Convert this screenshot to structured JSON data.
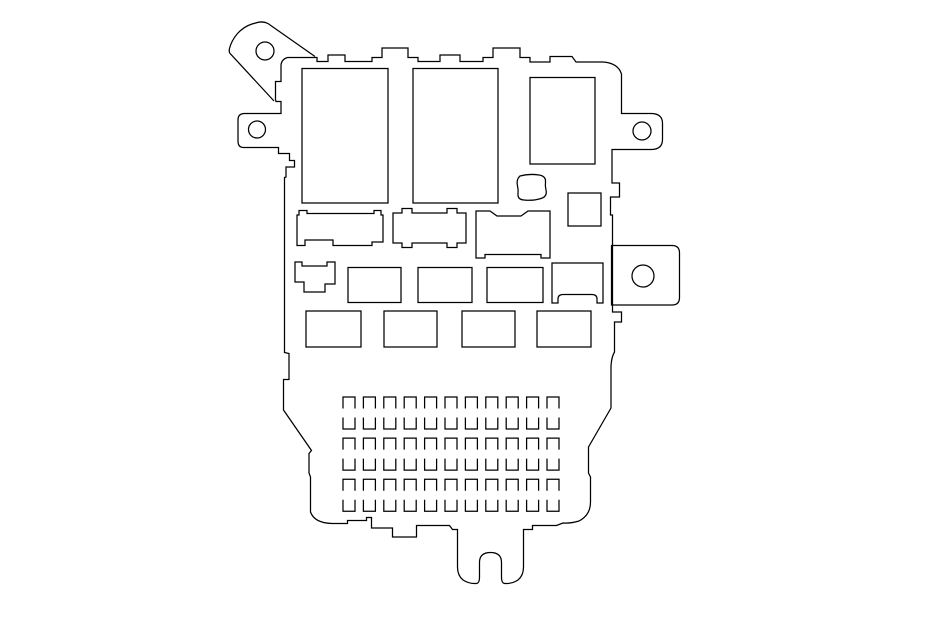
{
  "canvas": {
    "width": 950,
    "height": 623,
    "background_color": "#ffffff",
    "line_color": "#000000",
    "line_width": 1.25
  },
  "diagram": {
    "kind": "fuse-box-outline-drawing",
    "body": {
      "name": "fuse-box-body-outline",
      "d": "M 295,57.5 H 317 V 61.5 H 328 V 55 H 345 V 61.5 H 372 V 57.5 H 382 V 48 H 408 V 57.5 H 418 V 61.5 H 440 V 55 H 460 V 61.5 H 483 V 57.5 H 493 V 48 H 520 V 57.5 H 530 V 62 H 550 V 56.5 H 572 L 576,62 H 603 Q 618,63 621.5,74 V 113.5 H 651 Q 662.5,113.5 662.5,123.5 V 139.5 Q 662.5,149.5 651,149.5 H 612 V 183 H 619.5 V 197 H 610.5 V 215 H 612.5 V 312 H 621.5 V 322 H 614.5 V 352 Q 611.5,357 611,366 V 408 L 588.5,447 V 473 L 590.5,477 V 502 Q 590.5,515 579,521 Q 571,523.5 563,523 L 556.5,525.5 H 532.5 V 529.5 H 523.5 V 567 Q 523.5,575.5 518,580 Q 512.5,583.5 506.5,583.5 H 504.5 Q 501.5,583 501.5,577.5 V 562.5 Q 501.5,552.5 490.5,552.5 Q 479.5,552.5 479.5,562.5 V 577.5 Q 479.5,583 476.5,583.5 H 474.5 Q 468.5,583.5 463,580 Q 457.5,575.5 457.5,567 V 529.5 H 452.5 L 449.5,525.5 H 416.5 V 537 H 392.5 V 528 H 371.5 V 517.5 H 366.5 V 520.5 H 347.5 V 523.5 H 332 Q 314.5,523 310.5,512 V 477 L 309,473 V 453.5 L 311.5,450.5 L 283.5,410 V 379.5 H 289 V 353.5 L 284.5,352.5 V 177.5 L 286,177 V 167 H 294.5 V 160.5 H 289.5 V 153.5 H 278.5 V 147.5 H 243.5 Q 238,147.5 238,141 V 120 Q 238,113.5 244.5,113.5 H 281 V 101.5 H 276 L 275.5,99.5 V 81.5 H 281 V 66 Q 281,59.5 287.5,57.5 Z"
    },
    "open_paths": [
      {
        "name": "mounting-bracket-top-left",
        "d": "M 315,56.5 L 268,23.5 Q 263,21 257.5,22.5 L 252,24 Q 244,26.5 237.5,33.5 Q 231.5,40.5 229.5,48.5 Q 228.5,52.5 231,54.5 L 274,101"
      }
    ],
    "closed_shapes": [
      {
        "name": "connector-tab-right",
        "d": "M 611.5,245.5 H 672 Q 679.5,245.5 679.5,253 V 297.5 Q 679.5,305 672,305 H 611.5 Z"
      },
      {
        "name": "relay-socket-left",
        "d": "M 297,215 L 299,215 V 210.5 H 307 V 213.5 H 374 V 210.5 H 381 V 215 L 383,215 V 242 L 372,242 V 245.5 L 333,245.5 V 240 L 305,240 V 245.5 L 297,245.5 Z"
      },
      {
        "name": "relay-socket-middle",
        "d": "M 393,213 H 402 V 208.5 H 412 V 213 H 447 V 208.5 H 457 V 213 H 466 V 243 H 457 V 247.5 H 447 V 243 H 412 V 247.5 H 402 V 243 H 393 Z"
      },
      {
        "name": "relay-socket-right",
        "d": "M 476,211 H 490 L 497,216 H 521 L 528,211 H 550 V 258 H 541 V 254.5 H 485 V 258 H 476 Z"
      },
      {
        "name": "connector-blob",
        "d": "M 520,176 Q 529,173.5 539,175 Q 546,176 545.5,182 Q 545,186 546,190 Q 547.5,196.5 541,198.5 Q 533,201 524,200 Q 517.5,199.5 518,194 Q 518.5,190 517.5,186 Q 516,179.5 520,176 Z"
      },
      {
        "name": "fuse-slot-boot",
        "d": "M 295,262 H 302 V 266 H 327 V 262 H 335 V 284 H 325 V 292 H 304 V 282 H 295 Z"
      },
      {
        "name": "fuse-slot-arch-bottom",
        "d": "M 552,263 H 603 V 303 H 597 V 299 Q 597,294.5 592,294.5 H 563 Q 558,294.5 558,299 V 303 H 552 Z"
      }
    ],
    "rects": [
      {
        "name": "relay-large-1",
        "x": 302,
        "y": 68.5,
        "w": 86,
        "h": 134.5
      },
      {
        "name": "relay-large-2",
        "x": 413,
        "y": 68.5,
        "w": 85,
        "h": 134.5
      },
      {
        "name": "relay-large-3",
        "x": 530,
        "y": 77.5,
        "w": 65,
        "h": 86.5
      },
      {
        "name": "relay-small-square",
        "x": 568,
        "y": 193,
        "w": 33,
        "h": 33
      },
      {
        "name": "fuse-slot-row1-1",
        "x": 348,
        "y": 267.5,
        "w": 53,
        "h": 35
      },
      {
        "name": "fuse-slot-row1-2",
        "x": 418,
        "y": 267.5,
        "w": 54,
        "h": 35
      },
      {
        "name": "fuse-slot-row1-3",
        "x": 487,
        "y": 267.5,
        "w": 56,
        "h": 35
      },
      {
        "name": "fuse-slot-row2-1",
        "x": 306,
        "y": 311,
        "w": 55,
        "h": 36
      },
      {
        "name": "fuse-slot-row2-2",
        "x": 384,
        "y": 311,
        "w": 53,
        "h": 36
      },
      {
        "name": "fuse-slot-row2-3",
        "x": 462,
        "y": 311,
        "w": 53,
        "h": 36
      },
      {
        "name": "fuse-slot-row2-4",
        "x": 537,
        "y": 311,
        "w": 54,
        "h": 36
      }
    ],
    "holes": [
      {
        "name": "bolt-hole-top-left",
        "cx": 265,
        "cy": 51,
        "r": 9
      },
      {
        "name": "bolt-hole-left",
        "cx": 257,
        "cy": 129.5,
        "r": 8.5
      },
      {
        "name": "bolt-hole-right",
        "cx": 642,
        "cy": 131,
        "r": 9
      },
      {
        "name": "bolt-hole-connector",
        "cx": 643,
        "cy": 276,
        "r": 11
      }
    ],
    "terminal_grid": {
      "name": "terminal-pin-grid",
      "cols": 11,
      "rows": 6,
      "x0": 343,
      "y0": 397,
      "pitch_x": 20.4,
      "pitch_y": 20.55,
      "cell_w": 12,
      "cell_h": 11.5,
      "row_styles": [
        "open-bottom",
        "open-top"
      ]
    }
  }
}
